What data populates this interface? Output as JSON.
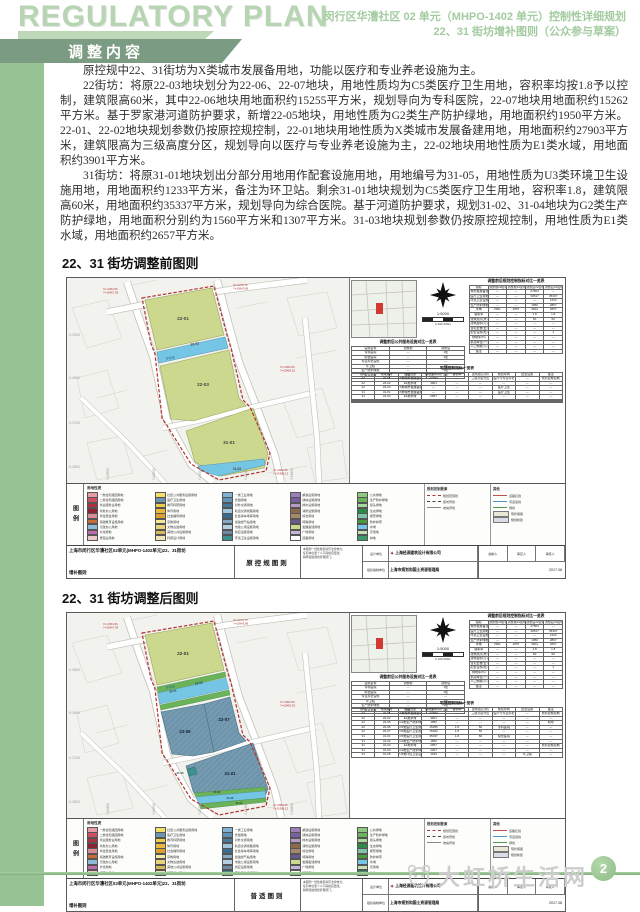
{
  "header": {
    "title": "REGULATORY PLAN",
    "subtitle_line1": "闵行区华漕社区 02 单元（MHPO-1402 单元）控制性详细规划",
    "subtitle_line2": "22、31 街坊增补图则（公众参与草案）",
    "ribbon_label": "调整内容"
  },
  "body": {
    "p1": "原控规中22、31街坊为X类城市发展备用地，功能以医疗和专业养老设施为主。",
    "p2": "22街坊：将原22-03地块划分为22-06、22-07地块，用地性质均为C5类医疗卫生用地，容积率均按1.8予以控制，建筑限高60米，其中22-06地块用地面积约15255平方米，规划导向为专科医院，22-07地块用地面积约15262平方米。基于罗家港河道防护要求，新增22-05地块，用地性质为G2类生产防护绿地，用地面积约1950平方米。22-01、22-02地块规划参数仍按原控规控制，22-01地块用地性质为X类城市发展备建用地，用地面积约27903平方米，建筑限高为三级高度分区，规划导向以医疗与专业养老设施为主，22-02地块用地性质为E1类水域，用地面积约3901平方米。",
    "p3": "31街坊：将原31-01地块划出分部分用地用作配套设施用地，用地编号为31-05，用地性质为U3类环境卫生设施用地，用地面积约1233平方米，备注为环卫站。剩余31-01地块规划为C5类医疗卫生用地，容积率1.8，建筑限高60米，用地面积约35337平方米，规划导向为综合医院。基于河道防护要求，规划31-02、31-04地块为G2类生产防护绿地，用地面积分别约为1560平方米和1307平方米。31-03地块规划参数仍按原控规控制，用地性质为E1类水域，用地面积约2657平方米。"
  },
  "sections": {
    "before": "22、31 街坊调整前图则",
    "after": "22、31 街坊调整后图则"
  },
  "map_shared": {
    "scale": "1:5000",
    "scale_ticks": "0    100    200m",
    "river_label": "罗家港",
    "coord_x": [
      "X-2500",
      "X-2600",
      "X-2700",
      "X-2800"
    ],
    "coord_y": [
      "Y-15800",
      "Y-16000",
      "Y-16200",
      "Y-16400",
      "Y-16600"
    ],
    "callouts": [
      {
        "l1": "X=-2454.36",
        "l2": "Y=15467.09"
      },
      {
        "l1": "X=-2373.76",
        "l2": "Y=15643.89"
      },
      {
        "l1": "X=-2562.06",
        "l2": "Y=15482.52"
      },
      {
        "l1": "X=-2683.45",
        "l2": "Y=15386.12"
      }
    ],
    "compare_table_title": "调整前后规划控制指标对比一览表",
    "compare_headers": [
      "指标",
      "调整前22街坊",
      "调整前31街坊",
      "调整后22街坊",
      "调整后31街坊"
    ],
    "compare_rows": [
      [
        "城市发展备建用地",
        "—",
        "—",
        "27903",
        "—"
      ],
      [
        "医疗卫生用地",
        "—",
        "—",
        "30517",
        "35337"
      ],
      [
        "环境卫生设施用地",
        "—",
        "—",
        "—",
        "1233"
      ],
      [
        "生产防护绿地",
        "—",
        "—",
        "1950",
        "2867"
      ],
      [
        "水域",
        "3901",
        "2657",
        "3901",
        "2657"
      ],
      [
        "容积率",
        "—",
        "—",
        "1.8",
        "1.8"
      ],
      [
        "建筑限高(米)",
        "—",
        "—",
        "60",
        "60"
      ],
      [
        "建筑面积(万㎡)",
        "—",
        "—",
        "—",
        "—"
      ],
      [
        "住宅套数(套)",
        "—",
        "—",
        "—",
        "—"
      ],
      [
        "配套设施(处)",
        "—",
        "—",
        "—",
        "1"
      ],
      [
        "绿地率(%)",
        "—",
        "—",
        "—",
        "—"
      ],
      [
        "机动车位(个)",
        "—",
        "—",
        "—",
        "—"
      ],
      [
        "人口规模(人)",
        "—",
        "—",
        "—",
        "—"
      ],
      [
        "备注",
        "—",
        "—",
        "—",
        "—"
      ]
    ],
    "facility_table_title": "调整前后公共服务设施对比一览表",
    "facility_headers": [
      "设施名称",
      "调整前",
      "调整后"
    ],
    "facility_rows": [
      [
        "专科医院",
        "—",
        "1处"
      ],
      [
        "综合医院",
        "—",
        "1处"
      ],
      [
        "专业养老设施",
        "—",
        "—"
      ],
      [
        "环卫站",
        "—",
        "1处"
      ],
      [
        "生产防护绿地",
        "—",
        "3处"
      ],
      [
        "河道水域",
        "2处",
        "2处"
      ]
    ],
    "block_table_title": "地块控制指标一览表",
    "block_headers": [
      "街坊",
      "地块编号",
      "用地性质",
      "用地面积(㎡)",
      "容积率",
      "建筑限高(米)",
      "规划导向",
      "配套设施",
      "备注"
    ],
    "legend_label": "图例",
    "legend_landuse_title": "用地性质",
    "legend_items": [
      {
        "label": "一类住宅组团用地",
        "color": "#e59aa4"
      },
      {
        "label": "二类住宅组团用地",
        "color": "#cf4f5e"
      },
      {
        "label": "商业服务业用地",
        "color": "#b03040"
      },
      {
        "label": "商务办公用地",
        "color": "#8c2333"
      },
      {
        "label": "商住混合用地",
        "color": "#d98a94"
      },
      {
        "label": "基础教育设施用地",
        "color": "#c96a3a"
      },
      {
        "label": "行政办公用地",
        "color": "#8fb9d6"
      },
      {
        "label": "文化用地",
        "color": "#c06ab0"
      },
      {
        "label": "旅馆业用地",
        "color": "#efc8cc"
      },
      {
        "label": "社区公共服务设施用地",
        "color": "#f2e06a"
      },
      {
        "label": "医疗卫生用地",
        "color": "#6e95ab"
      },
      {
        "label": "教育科研用地",
        "color": "#eecf4a"
      },
      {
        "label": "体育用地",
        "color": "#e8b93c"
      },
      {
        "label": "社会福利用地",
        "color": "#dca12f"
      },
      {
        "label": "宗教用地",
        "color": "#f5ea9a"
      },
      {
        "label": "文物古迹用地",
        "color": "#e8d27a"
      },
      {
        "label": "其他公共设施用地",
        "color": "#d9b75a"
      },
      {
        "label": "科研设计用地",
        "color": "#f0e4b4"
      },
      {
        "label": "一类工业用地",
        "color": "#7fb3d1"
      },
      {
        "label": "仓储用地",
        "color": "#5f93b8"
      },
      {
        "label": "对外交通用地",
        "color": "#46789e"
      },
      {
        "label": "轨道交通线路用地",
        "color": "#9fc6dd"
      },
      {
        "label": "社会停车场库用地",
        "color": "#3a6a8e"
      },
      {
        "label": "加油加气站用地",
        "color": "#86a8c4"
      },
      {
        "label": "市政公用设施用地",
        "color": "#b4cfe0"
      },
      {
        "label": "供应设施用地",
        "color": "#6d89a8"
      },
      {
        "label": "环境卫生设施用地",
        "color": "#3f8f8f"
      },
      {
        "label": "邮政设施用地",
        "color": "#9a7fb8"
      },
      {
        "label": "通信设施用地",
        "color": "#7a5f9e"
      },
      {
        "label": "排水设施用地",
        "color": "#b89ac8"
      },
      {
        "label": "消防设施用地",
        "color": "#8a6a4a"
      },
      {
        "label": "综合用地",
        "color": "#a8886a"
      },
      {
        "label": "特殊用地",
        "color": "#6a5a8e"
      },
      {
        "label": "发展备建用地",
        "color": "#ccd88e"
      },
      {
        "label": "广场用地",
        "color": "#c4b4d6"
      },
      {
        "label": "道路用地",
        "color": "#ffffff"
      },
      {
        "label": "公共绿地",
        "color": "#8fc87f"
      },
      {
        "label": "生产防护绿地",
        "color": "#6ab35a"
      },
      {
        "label": "街头绿地",
        "color": "#a8d89a"
      },
      {
        "label": "生态绿地",
        "color": "#2f8a4a"
      },
      {
        "label": "楔形绿地",
        "color": "#7fc4a8"
      },
      {
        "label": "防护林带",
        "color": "#4a9a3e"
      },
      {
        "label": "水域",
        "color": "#74c6e4"
      },
      {
        "label": "农用地",
        "color": "#c4e0b4"
      },
      {
        "label": "林地",
        "color": "#3a9a6a"
      }
    ],
    "legend_control_title": "规划控制要素",
    "legend_control_items": [
      {
        "label": "规划范围线",
        "style": "red-dash"
      },
      {
        "label": "街坊界线",
        "style": "dark-dash"
      },
      {
        "label": "地块界线",
        "style": "gray-solid"
      }
    ],
    "legend_other_title": "其他",
    "legend_other_items": [
      {
        "label": "道路红线",
        "style": "thin-red"
      },
      {
        "label": "河道蓝线",
        "style": "thin-blue"
      },
      {
        "label": "绿线",
        "style": "thin-green"
      },
      {
        "label": "现状保留",
        "swatch": "#eae6d8"
      },
      {
        "label": "规划新建",
        "swatch": "#d8dde8"
      }
    ],
    "titleblock": {
      "project_line1": "上海市闵行区华漕社区02单元(MHPO-1402单元)22、31街坊",
      "project_line2": "增补图则",
      "note_line1": "本图则一经批准即具有法律效力，",
      "note_line2": "任何单位和个人不得擅自更改。",
      "note_line3": "解释权属规划管理部门。",
      "design_label": "设计单位",
      "design_value": "上海经源建筑设计有限公司",
      "org_label": "组织编制单位",
      "org_value": "上海市规划和国土资源管理局",
      "staff_labels": [
        "编制人",
        "审定人",
        "审核人"
      ],
      "date": "2017.08"
    }
  },
  "map_before": {
    "sheet_type": "原控规图则",
    "parcels": {
      "top": "22-01",
      "water": "22-02",
      "mid": "22-03",
      "bottom": "31-01",
      "strip": "31-03"
    },
    "block_rows": [
      [
        "22",
        "22-01",
        "X类城市发展备建用地",
        "27903",
        "—",
        "三级高度分区",
        "医疗与专业养老",
        "—",
        "按原控规控制"
      ],
      [
        "22",
        "22-02",
        "E1类水域",
        "3901",
        "—",
        "—",
        "—",
        "—",
        "—"
      ],
      [
        "22",
        "22-03",
        "X类城市发展备用地",
        "—",
        "—",
        "—",
        "医疗卫生",
        "—",
        "—"
      ],
      [
        "31",
        "31-01",
        "X类城市发展备用地",
        "—",
        "—",
        "—",
        "医疗卫生",
        "—",
        "—"
      ],
      [
        "31",
        "31-03",
        "E1类水域",
        "2657",
        "—",
        "—",
        "—",
        "—",
        "—"
      ],
      [
        "",
        "",
        "",
        "",
        "",
        "",
        "",
        "",
        ""
      ],
      [
        "",
        "",
        "",
        "",
        "",
        "",
        "",
        "",
        ""
      ],
      [
        "",
        "",
        "",
        "",
        "",
        "",
        "",
        "",
        ""
      ]
    ]
  },
  "map_after": {
    "sheet_type": "普适图则",
    "parcels": {
      "top": "22-01",
      "green_n": "22-05",
      "water": "22-02",
      "mid_left": "22-06",
      "mid_right": "22-07",
      "bottom": "31-01",
      "s_green1": "31-02",
      "s_water": "31-03",
      "s_green2": "31-04",
      "u3": "31-05"
    },
    "block_rows": [
      [
        "22",
        "22-01",
        "X类城市发展备建用地",
        "27903",
        "—",
        "三级高度分区",
        "医疗与专业养老",
        "—",
        "按原控规控制"
      ],
      [
        "22",
        "22-02",
        "E1类水域",
        "3901",
        "—",
        "—",
        "—",
        "—",
        "—"
      ],
      [
        "22",
        "22-05",
        "G2类生产防护绿地",
        "1950",
        "—",
        "—",
        "—",
        "—",
        "新增"
      ],
      [
        "22",
        "22-06",
        "C5类医疗卫生用地",
        "15255",
        "1.8",
        "60",
        "专科医院",
        "—",
        "—"
      ],
      [
        "22",
        "22-07",
        "C5类医疗卫生用地",
        "15262",
        "1.8",
        "60",
        "—",
        "—",
        "—"
      ],
      [
        "31",
        "31-01",
        "C5类医疗卫生用地",
        "35337",
        "1.8",
        "60",
        "综合医院",
        "—",
        "—"
      ],
      [
        "31",
        "31-02",
        "G2类生产防护绿地",
        "1560",
        "—",
        "—",
        "—",
        "—",
        "—"
      ],
      [
        "31",
        "31-03",
        "E1类水域",
        "2657",
        "—",
        "—",
        "—",
        "—",
        "按原控规控制"
      ],
      [
        "31",
        "31-04",
        "G2类生产防护绿地",
        "1307",
        "—",
        "—",
        "—",
        "—",
        "—"
      ],
      [
        "31",
        "31-05",
        "U3类环境卫生设施用地",
        "1233",
        "—",
        "—",
        "—",
        "环卫站",
        "—"
      ]
    ]
  },
  "footer": {
    "page_number": "2",
    "watermark": "大虹桥生活网"
  },
  "colors": {
    "ribbon": "#7b9c83",
    "left_strip": "#96c294",
    "header_text": "#a3cba0",
    "parcel_yellow": "#ccd88e",
    "water_blue": "#74c6e4",
    "c5_slate": "#6e95ab",
    "protect_green": "#6ab35a",
    "u3_teal": "#3f8f8f",
    "boundary_red": "#b23230",
    "footer_green": "#8cbd86"
  }
}
